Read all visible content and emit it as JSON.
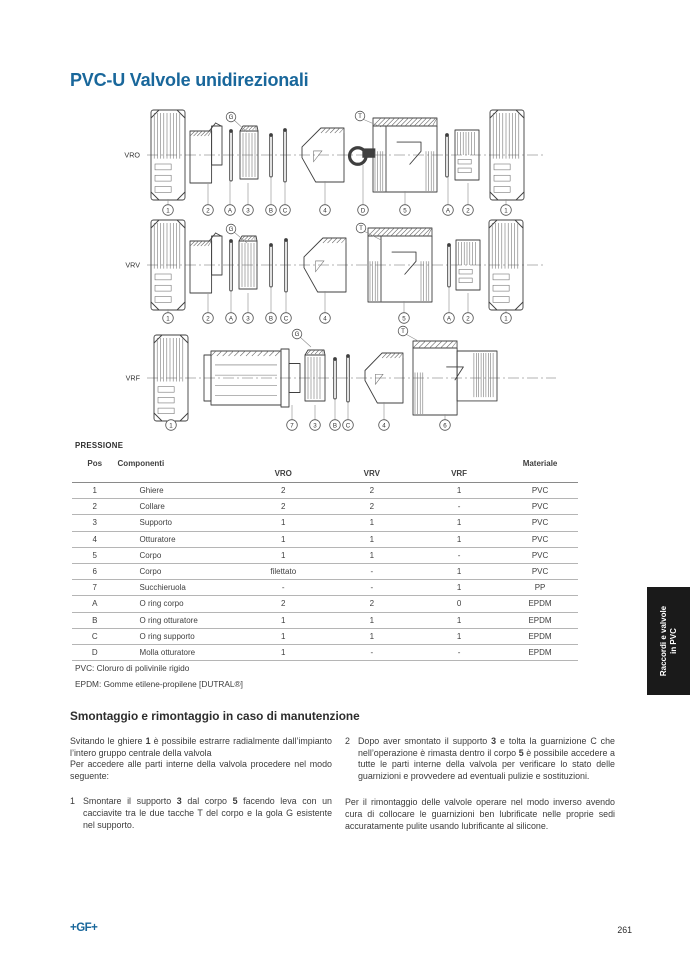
{
  "colors": {
    "title_blue": "#19679B",
    "logo_blue": "#19679B",
    "tab_bg": "#1A1A1A",
    "tab_text": "#FFFFFF",
    "body_text": "#3C3C3C",
    "line_gray": "#B5B5B5"
  },
  "page": {
    "title": "PVC-U Valvole unidirezionali",
    "footer_logo": "+GF+",
    "page_number": "261",
    "side_tab": {
      "line1": "Raccordi e valvole",
      "line2": "in PVC"
    }
  },
  "diagram": {
    "rows": [
      {
        "label": "VRO",
        "cy": 155,
        "label_x": 140,
        "cly": [
          147,
          545
        ],
        "coy": 210,
        "top_labels": [
          {
            "label": "G",
            "x": 231,
            "y": 117,
            "tx": 247,
            "ty": 132
          },
          {
            "label": "T",
            "x": 360,
            "y": 116,
            "tx": 381,
            "ty": 127
          }
        ],
        "parts": [
          {
            "type": "nut",
            "x": 168,
            "w": 17,
            "h": 45
          },
          {
            "type": "collar",
            "x": 206,
            "w": 16,
            "h": 30
          },
          {
            "type": "oring",
            "x": 231,
            "w": 2,
            "h": 27
          },
          {
            "type": "support",
            "x": 249,
            "w": 9,
            "h": 29
          },
          {
            "type": "oring",
            "x": 271,
            "w": 2,
            "h": 23
          },
          {
            "type": "oring",
            "x": 285,
            "w": 2,
            "h": 28
          },
          {
            "type": "cone",
            "x": 323,
            "w": 21,
            "h": 27
          },
          {
            "type": "spring",
            "x": 363,
            "w": 13,
            "h": 11
          },
          {
            "type": "body",
            "x": 405,
            "w": 32,
            "h": 37
          },
          {
            "type": "oring",
            "x": 447,
            "w": 2,
            "h": 23
          },
          {
            "type": "collar2",
            "x": 467,
            "w": 12,
            "h": 29
          },
          {
            "type": "nut",
            "x": 507,
            "w": 17,
            "h": 45
          }
        ],
        "callouts": [
          {
            "l": "1",
            "x": 168
          },
          {
            "l": "2",
            "x": 208
          },
          {
            "l": "A",
            "x": 230
          },
          {
            "l": "3",
            "x": 248
          },
          {
            "l": "B",
            "x": 271
          },
          {
            "l": "C",
            "x": 285
          },
          {
            "l": "4",
            "x": 325
          },
          {
            "l": "D",
            "x": 363
          },
          {
            "l": "5",
            "x": 405
          },
          {
            "l": "A",
            "x": 448
          },
          {
            "l": "2",
            "x": 468
          },
          {
            "l": "1",
            "x": 506
          }
        ]
      },
      {
        "label": "VRV",
        "cy": 265,
        "label_x": 140,
        "cly": [
          147,
          545
        ],
        "coy": 318,
        "top_labels": [
          {
            "label": "G",
            "x": 231,
            "y": 229,
            "tx": 247,
            "ty": 243
          },
          {
            "label": "T",
            "x": 361,
            "y": 228,
            "tx": 381,
            "ty": 240
          }
        ],
        "parts": [
          {
            "type": "nut",
            "x": 168,
            "w": 17,
            "h": 45
          },
          {
            "type": "collar",
            "x": 206,
            "w": 16,
            "h": 30
          },
          {
            "type": "oring",
            "x": 231,
            "w": 2,
            "h": 27
          },
          {
            "type": "support",
            "x": 248,
            "w": 9,
            "h": 29
          },
          {
            "type": "oring",
            "x": 271,
            "w": 2,
            "h": 23
          },
          {
            "type": "oring",
            "x": 286,
            "w": 2,
            "h": 28
          },
          {
            "type": "cone",
            "x": 325,
            "w": 21,
            "h": 27
          },
          {
            "type": "body",
            "x": 400,
            "w": 32,
            "h": 37
          },
          {
            "type": "oring",
            "x": 449,
            "w": 2,
            "h": 23
          },
          {
            "type": "collar2",
            "x": 468,
            "w": 12,
            "h": 29
          },
          {
            "type": "nut",
            "x": 506,
            "w": 17,
            "h": 45
          }
        ],
        "callouts": [
          {
            "l": "1",
            "x": 168
          },
          {
            "l": "2",
            "x": 208
          },
          {
            "l": "A",
            "x": 231
          },
          {
            "l": "3",
            "x": 248
          },
          {
            "l": "B",
            "x": 271
          },
          {
            "l": "C",
            "x": 286
          },
          {
            "l": "4",
            "x": 325
          },
          {
            "l": "5",
            "x": 404
          },
          {
            "l": "A",
            "x": 449
          },
          {
            "l": "2",
            "x": 468
          },
          {
            "l": "1",
            "x": 506
          }
        ]
      },
      {
        "label": "VRF",
        "cy": 378,
        "label_x": 140,
        "cly": [
          147,
          556
        ],
        "coy": 425,
        "top_labels": [
          {
            "label": "G",
            "x": 297,
            "y": 334,
            "tx": 311,
            "ty": 347
          },
          {
            "label": "T",
            "x": 403,
            "y": 331,
            "tx": 420,
            "ty": 342
          }
        ],
        "parts": [
          {
            "type": "nut",
            "x": 171,
            "w": 17,
            "h": 43
          },
          {
            "type": "strainer",
            "x": 252,
            "w": 48,
            "h": 29
          },
          {
            "type": "support",
            "x": 315,
            "w": 10,
            "h": 28
          },
          {
            "type": "oring",
            "x": 335,
            "w": 2,
            "h": 22
          },
          {
            "type": "oring",
            "x": 348,
            "w": 2,
            "h": 25
          },
          {
            "type": "cone",
            "x": 384,
            "w": 19,
            "h": 25
          },
          {
            "type": "body6",
            "x": 455,
            "w": 42,
            "h": 37
          }
        ],
        "callouts": [
          {
            "l": "1",
            "x": 171
          },
          {
            "l": "7",
            "x": 292
          },
          {
            "l": "3",
            "x": 315
          },
          {
            "l": "B",
            "x": 335
          },
          {
            "l": "C",
            "x": 348
          },
          {
            "l": "4",
            "x": 384
          },
          {
            "l": "6",
            "x": 445
          }
        ]
      }
    ]
  },
  "table": {
    "section_label": "PRESSIONE",
    "headers": {
      "pos": "Pos",
      "componenti": "Componenti",
      "vro": "VRO",
      "vrv": "VRV",
      "vrf": "VRF",
      "materiale": "Materiale"
    },
    "rows": [
      [
        "1",
        "Ghiere",
        "2",
        "2",
        "1",
        "PVC"
      ],
      [
        "2",
        "Collare",
        "2",
        "2",
        "-",
        "PVC"
      ],
      [
        "3",
        "Supporto",
        "1",
        "1",
        "1",
        "PVC"
      ],
      [
        "4",
        "Otturatore",
        "1",
        "1",
        "1",
        "PVC"
      ],
      [
        "5",
        "Corpo",
        "1",
        "1",
        "-",
        "PVC"
      ],
      [
        "6",
        "Corpo",
        "filettato",
        "-",
        "1",
        "PVC"
      ],
      [
        "7",
        "Succhieruola",
        "-",
        "-",
        "1",
        "PP"
      ],
      [
        "A",
        "O ring corpo",
        "2",
        "2",
        "0",
        "EPDM"
      ],
      [
        "B",
        "O ring otturatore",
        "1",
        "1",
        "1",
        "EPDM"
      ],
      [
        "C",
        "O ring supporto",
        "1",
        "1",
        "1",
        "EPDM"
      ],
      [
        "D",
        "Molla otturatore",
        "1",
        "-",
        "-",
        "EPDM"
      ]
    ],
    "footnotes": [
      "PVC: Cloruro di polivinile rigido",
      "EPDM: Gomme etilene-propilene [DUTRAL®]"
    ]
  },
  "maintenance": {
    "heading": "Smontaggio e rimontaggio in caso di manutenzione",
    "left_column": [
      {
        "type": "para",
        "mb": 0,
        "segments": [
          {
            "t": "Svitando le ghiere "
          },
          {
            "t": "1",
            "b": true
          },
          {
            "t": " è possibile estrarre radialmente dall’impianto l’intero gruppo centrale della valvola"
          }
        ]
      },
      {
        "type": "para",
        "mb": 14,
        "segments": [
          {
            "t": "Per accedere alle parti interne della valvola procedere nel modo seguente:"
          }
        ]
      },
      {
        "type": "item",
        "num": "1",
        "mb": 0,
        "segments": [
          {
            "t": "Smontare il supporto "
          },
          {
            "t": "3",
            "b": true
          },
          {
            "t": " dal corpo "
          },
          {
            "t": "5",
            "b": true
          },
          {
            "t": " facendo leva con un cacciavite tra le due tacche T del corpo e la gola G esistente nel supporto."
          }
        ]
      }
    ],
    "right_column": [
      {
        "type": "item",
        "num": "2",
        "mb": 15,
        "segments": [
          {
            "t": "Dopo aver smontato il supporto "
          },
          {
            "t": "3",
            "b": true
          },
          {
            "t": " e tolta la guarnizione C che nell’operazione è rimasta dentro il corpo "
          },
          {
            "t": "5",
            "b": true
          },
          {
            "t": " è possibile accedere a tutte le parti interne della valvola per verificare lo stato delle guarnizioni e provvedere ad eventuali pulizie e sostituzioni."
          }
        ]
      },
      {
        "type": "para",
        "mb": 0,
        "segments": [
          {
            "t": "Per il rimontaggio delle valvole operare nel modo inverso avendo cura di collocare le guarnizioni ben lubrificate nelle proprie sedi accuratamente pulite usando lubrificante al silicone."
          }
        ]
      }
    ]
  }
}
